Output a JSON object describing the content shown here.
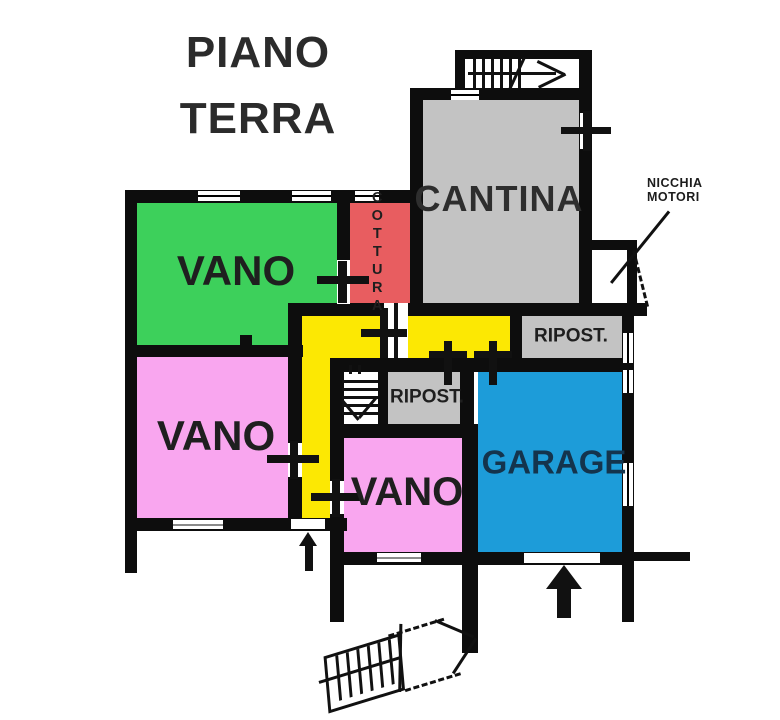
{
  "title": {
    "line1": "PIANO",
    "line2": "TERRA"
  },
  "rooms": {
    "vano_green": {
      "label": "VANO"
    },
    "vano_pink_left": {
      "label": "VANO"
    },
    "vano_pink_bottom": {
      "label": "VANO"
    },
    "cantina": {
      "label": "CANTINA"
    },
    "cottura": {
      "label": "COTTURA"
    },
    "ripost_top": {
      "label": "RIPOST."
    },
    "ripost_mid": {
      "label": "RIPOST."
    },
    "garage": {
      "label": "GARAGE"
    }
  },
  "annotations": {
    "nicchia": {
      "line1": "NICCHIA",
      "line2": "MOTORI"
    }
  },
  "colors": {
    "wall": "#0d0d0d",
    "green": "#3dd05b",
    "pink": "#f9a6ef",
    "red": "#e85d60",
    "yellow": "#fce803",
    "gray": "#c3c3c3",
    "blue": "#1d9cd9",
    "label_text": "#1f1f1f",
    "garage_text": "#14344d"
  }
}
